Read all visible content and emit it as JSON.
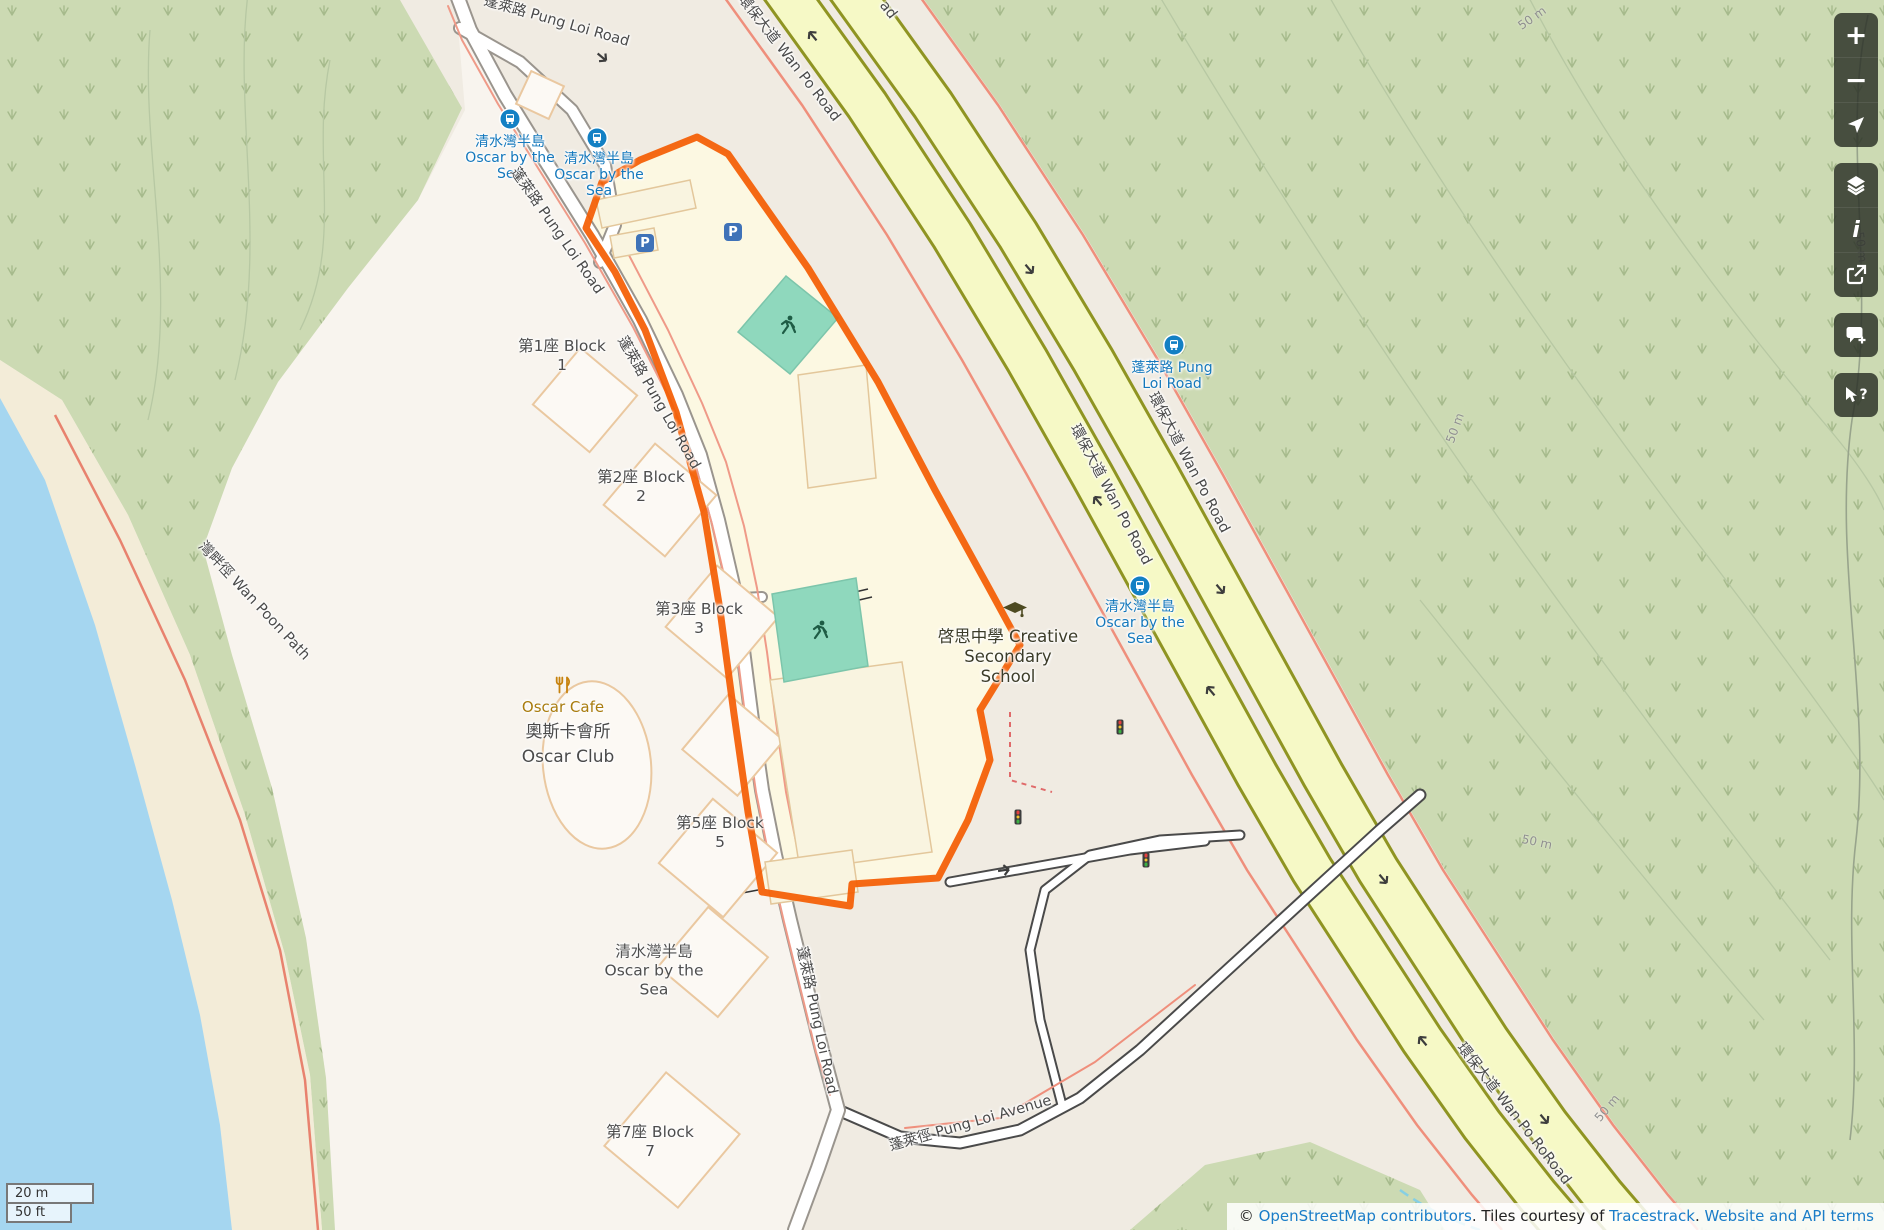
{
  "poi": {
    "school_line1": "啓思中學 Creative",
    "school_line2": "Secondary",
    "school_line3": "School",
    "cafe_name": "Oscar Cafe",
    "club_name_zh": "奧斯卡會所",
    "club_name_en": "Oscar Club",
    "parking_label": "P"
  },
  "blocks": [
    {
      "name": "第1座 Block",
      "number": "1"
    },
    {
      "name": "第2座 Block",
      "number": "2"
    },
    {
      "name": "第3座 Block",
      "number": "3"
    },
    {
      "name": "第5座 Block",
      "number": "5"
    },
    {
      "name": "第7座 Block",
      "number": "7"
    }
  ],
  "residential_area": {
    "line1": "清水灣半島",
    "line2": "Oscar by the",
    "line3": "Sea"
  },
  "bus_stops": [
    {
      "line1": "清水灣半島",
      "line2": "Oscar by the",
      "line3": "Sea"
    },
    {
      "line1": "清水灣半島",
      "line2": "Oscar by the",
      "line3": "Sea"
    },
    {
      "line1": "蓬萊路 Pung",
      "line2": "Loi Road"
    },
    {
      "line1": "清水灣半島",
      "line2": "Oscar by the",
      "line3": "Sea"
    }
  ],
  "road_labels": {
    "pung_loi_top": "蓬萊路 Pung Loi Road",
    "pung_loi_upper": "蓬萊路 Pung Loi Road",
    "pung_loi_mid": "蓬萊路 Pung Loi Road",
    "pung_loi_south": "蓬萊路 Pung Loi Road",
    "pung_loi_avenue": "蓬萊徑 Pung Loi Avenue",
    "wan_po_top": "環保大道 Wan Po Road",
    "wan_po_top_partial": "ad",
    "wan_po_left": "環保大道 Wan Po Road",
    "wan_po_right": "環保大道 Wan Po Road",
    "wan_po_bottom": "環保大道 Wan Po RoRoad",
    "wan_poon_path": "灣畔徑 Wan Poon Path"
  },
  "contour_label": "50 m",
  "scalebar": {
    "metric": "20 m",
    "imperial": "50 ft"
  },
  "attribution": {
    "copyright_symbol": "©",
    "osm_link": "OpenStreetMap contributors",
    "tiles_text": ". Tiles courtesy of",
    "tracestrack_link": "Tracestrack",
    "period": ".",
    "terms_link": "Website and API terms"
  },
  "controls": {
    "zoom_in": "+",
    "zoom_out": "−",
    "info_glyph": "i",
    "query_glyph": "?"
  },
  "colors": {
    "highlight": "#f45c02",
    "water": "#a5d6f0",
    "forest": "#ccdab3",
    "highway_fill": "#f6f9c6",
    "bus_blue": "#1380c4",
    "link_blue": "#1a7dc8"
  }
}
